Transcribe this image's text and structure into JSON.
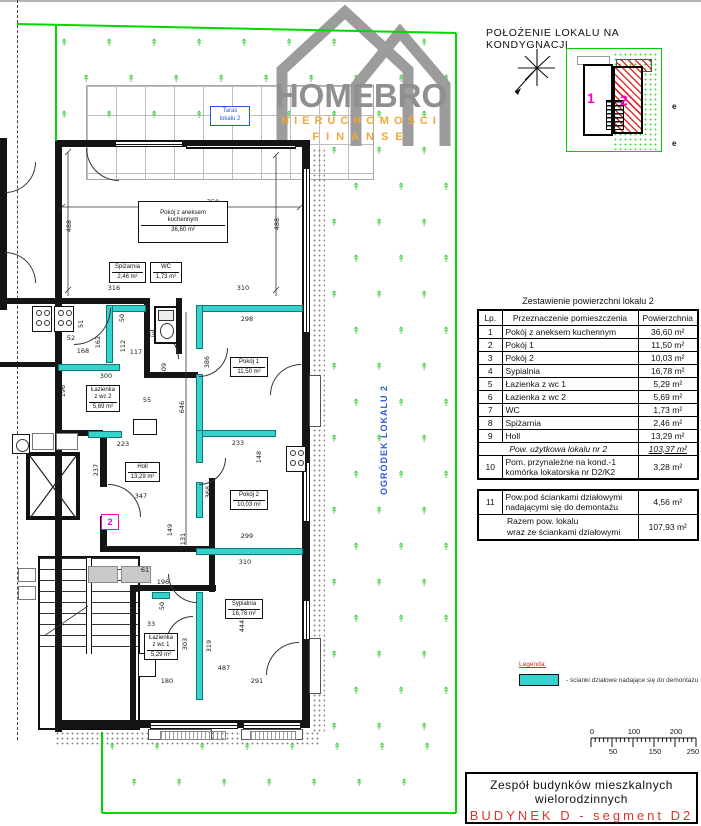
{
  "header": {
    "location_title": "POŁOŻENIE LOKALU NA KONDYGNACJI"
  },
  "logo": {
    "name": "HOMEBRO",
    "subtitle1": "NIERUCHOMOŚCI",
    "subtitle2": "FINANSE"
  },
  "key_plan": {
    "unit1": "1",
    "unit2": "2",
    "marks": [
      "e",
      "e"
    ]
  },
  "area_table": {
    "title": "Zestawienie powierzchni lokalu 2",
    "columns": [
      "Lp.",
      "Przeznaczenie pomieszczenia",
      "Powierzchnia"
    ],
    "rows": [
      [
        "1",
        "Pokój z aneksem kuchennym",
        "36,60 m²"
      ],
      [
        "2",
        "Pokój 1",
        "11,50 m²"
      ],
      [
        "3",
        "Pokój 2",
        "10,03 m²"
      ],
      [
        "4",
        "Sypialnia",
        "16,78 m²"
      ],
      [
        "5",
        "Łazienka z wc 1",
        "5,29 m²"
      ],
      [
        "6",
        "Łazienka z wc 2",
        "5,69 m²"
      ],
      [
        "7",
        "WC",
        "1,73 m²"
      ],
      [
        "8",
        "Spiżarnia",
        "2,46 m²"
      ],
      [
        "9",
        "Holl",
        "13,29 m²"
      ]
    ],
    "subtotal": {
      "label": "Pow. użytkowa lokalu nr 2",
      "value": "103,37 m²"
    },
    "row10": {
      "lp": "10",
      "label1": "Pom. przynależne na kond.-1",
      "label2": "komórka lokatorska nr D2/K2",
      "value": "3,28 m²"
    },
    "row11": {
      "lp": "11",
      "label1": "Pow.pod ściankami działowymi",
      "label2": "nadającymi się do demontażu",
      "value": "4,56 m²"
    },
    "total": {
      "label1": "Razem pow. lokalu",
      "label2": "wraz ze ściankami działowymi",
      "value": "107,93 m²"
    }
  },
  "legend": {
    "title": "Legenda:",
    "item": "- ścianki działowe nadające się do demontażu"
  },
  "scale_bar": {
    "top_labels": [
      "0",
      "100",
      "200"
    ],
    "bottom_labels": [
      "50",
      "150",
      "250 cm"
    ]
  },
  "title_block": {
    "line1": "Zespół budynków mieszkalnych",
    "line2": "wielorodzinnych",
    "line3": "BUDYNEK D - segment D2"
  },
  "floor_plan": {
    "terrace_label": {
      "line1": "Taras",
      "line2": "lokalu 2"
    },
    "garden_label": "OGRÓDEK LOKALU 2",
    "unit_number": "2",
    "rooms": [
      {
        "lines": [
          "Pokój z aneksem",
          "kuchennym"
        ],
        "area": "36,60 m²",
        "x": 138,
        "y": 201,
        "w": 90,
        "h": 42
      },
      {
        "lines": [
          "Spiżarnia"
        ],
        "area": "2,46 m²",
        "x": 109,
        "y": 262,
        "w": 37,
        "h": 21
      },
      {
        "lines": [
          "WC"
        ],
        "area": "1,73 m²",
        "x": 150,
        "y": 262,
        "w": 32,
        "h": 21
      },
      {
        "lines": [
          "Pokój 1"
        ],
        "area": "11,50 m²",
        "x": 230,
        "y": 357,
        "w": 38,
        "h": 20
      },
      {
        "lines": [
          "Łazienka",
          "z wc 2"
        ],
        "area": "5,69 m²",
        "x": 86,
        "y": 385,
        "w": 34,
        "h": 27
      },
      {
        "lines": [
          "Holl"
        ],
        "area": "13,29 m²",
        "x": 125,
        "y": 462,
        "w": 35,
        "h": 20
      },
      {
        "lines": [
          "Pokój 2"
        ],
        "area": "10,03 m²",
        "x": 230,
        "y": 490,
        "w": 38,
        "h": 20
      },
      {
        "lines": [
          "Sypialnia"
        ],
        "area": "16,78 m²",
        "x": 225,
        "y": 599,
        "w": 38,
        "h": 20
      },
      {
        "lines": [
          "Łazienka",
          "z wc 1"
        ],
        "area": "5,29 m²",
        "x": 144,
        "y": 633,
        "w": 34,
        "h": 27
      }
    ],
    "dimensions": [
      {
        "t": "750",
        "x": 202,
        "y": 198,
        "o": "h"
      },
      {
        "t": "488",
        "x": 58,
        "y": 222,
        "o": "v"
      },
      {
        "t": "488",
        "x": 266,
        "y": 220,
        "o": "v"
      },
      {
        "t": "316",
        "x": 103,
        "y": 284,
        "o": "h"
      },
      {
        "t": "310",
        "x": 232,
        "y": 284,
        "o": "h"
      },
      {
        "t": "298",
        "x": 236,
        "y": 315,
        "o": "h"
      },
      {
        "t": "51",
        "x": 70,
        "y": 320,
        "o": "v"
      },
      {
        "t": "52",
        "x": 60,
        "y": 334,
        "o": "h"
      },
      {
        "t": "162",
        "x": 87,
        "y": 338,
        "o": "v"
      },
      {
        "t": "168",
        "x": 72,
        "y": 347,
        "o": "h"
      },
      {
        "t": "50",
        "x": 111,
        "y": 314,
        "o": "v"
      },
      {
        "t": "112",
        "x": 112,
        "y": 342,
        "o": "v"
      },
      {
        "t": "117",
        "x": 125,
        "y": 348,
        "o": "h"
      },
      {
        "t": "33",
        "x": 140,
        "y": 331,
        "o": "h"
      },
      {
        "t": "300",
        "x": 95,
        "y": 372,
        "o": "h"
      },
      {
        "t": "196",
        "x": 52,
        "y": 387,
        "o": "v"
      },
      {
        "t": "409",
        "x": 153,
        "y": 365,
        "o": "v"
      },
      {
        "t": "646",
        "x": 171,
        "y": 403,
        "o": "v"
      },
      {
        "t": "55",
        "x": 136,
        "y": 396,
        "o": "h"
      },
      {
        "t": "386",
        "x": 196,
        "y": 358,
        "o": "v"
      },
      {
        "t": "223",
        "x": 112,
        "y": 440,
        "o": "h"
      },
      {
        "t": "237",
        "x": 85,
        "y": 466,
        "o": "v"
      },
      {
        "t": "347",
        "x": 130,
        "y": 492,
        "o": "h"
      },
      {
        "t": "233",
        "x": 227,
        "y": 439,
        "o": "h"
      },
      {
        "t": "148",
        "x": 248,
        "y": 453,
        "o": "v"
      },
      {
        "t": "368",
        "x": 197,
        "y": 488,
        "o": "v"
      },
      {
        "t": "149",
        "x": 159,
        "y": 526,
        "o": "v"
      },
      {
        "t": "131",
        "x": 172,
        "y": 535,
        "o": "v"
      },
      {
        "t": "299",
        "x": 236,
        "y": 532,
        "o": "h"
      },
      {
        "t": "310",
        "x": 234,
        "y": 558,
        "o": "h"
      },
      {
        "t": "61",
        "x": 134,
        "y": 566,
        "o": "h"
      },
      {
        "t": "196",
        "x": 152,
        "y": 578,
        "o": "h"
      },
      {
        "t": "50",
        "x": 151,
        "y": 602,
        "o": "v"
      },
      {
        "t": "33",
        "x": 140,
        "y": 620,
        "o": "h"
      },
      {
        "t": "303",
        "x": 174,
        "y": 640,
        "o": "v"
      },
      {
        "t": "319",
        "x": 198,
        "y": 642,
        "o": "v"
      },
      {
        "t": "444",
        "x": 231,
        "y": 622,
        "o": "v"
      },
      {
        "t": "487",
        "x": 213,
        "y": 664,
        "o": "h"
      },
      {
        "t": "180",
        "x": 156,
        "y": 677,
        "o": "h"
      },
      {
        "t": "291",
        "x": 246,
        "y": 677,
        "o": "h"
      }
    ]
  }
}
